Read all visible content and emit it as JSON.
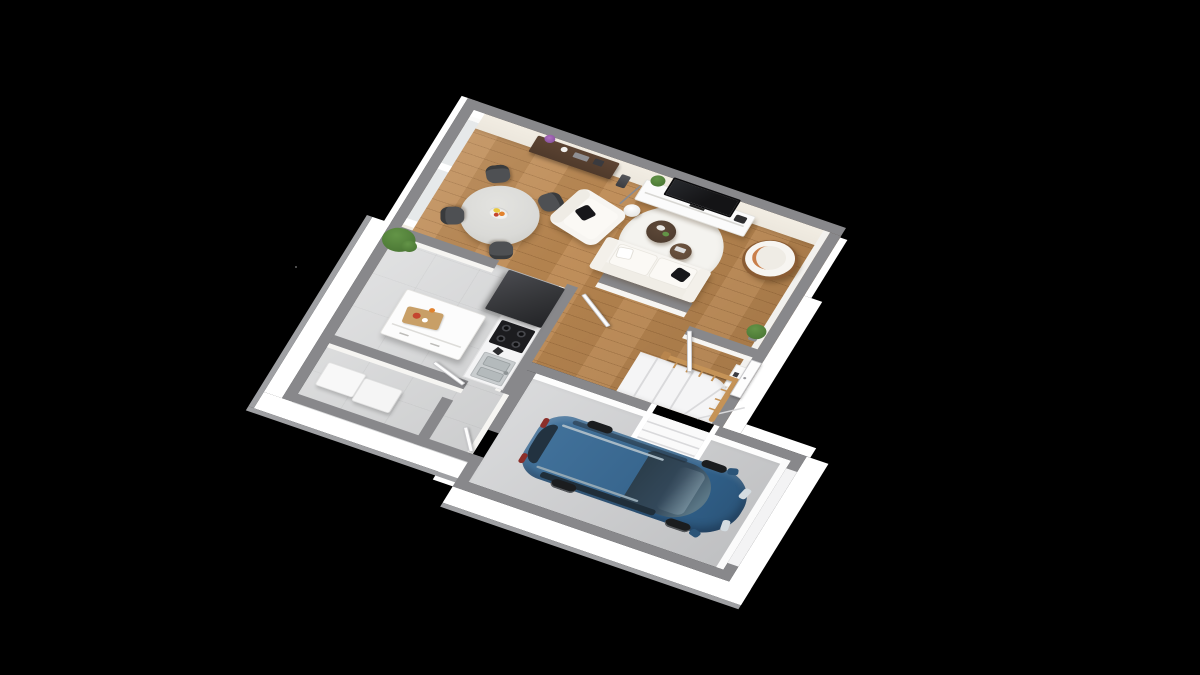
{
  "scene": {
    "label": "3D isometric floor plan rendering of a ground floor: open living-dining room with wood floor, kitchen with island, laundry room, hallway with winder staircase, and a garage with a parked blue minivan, on a black background",
    "background": "#000000"
  },
  "rooms": {
    "living_dining": {
      "label": "Living and dining room",
      "floor": "wood planks"
    },
    "kitchen": {
      "label": "Kitchen",
      "floor": "grey tile"
    },
    "laundry": {
      "label": "Laundry / storage room",
      "floor": "grey tile"
    },
    "hallway": {
      "label": "Hallway with staircase",
      "floor": "wood planks"
    },
    "garage": {
      "label": "Garage",
      "floor": "grey concrete"
    }
  },
  "furniture": {
    "dining": [
      "round pedestal dining table",
      "fruit bowl with bananas, oranges and apples",
      "four dark grey dining chairs",
      "large potted plant on half wall"
    ],
    "living": [
      "dark-wood console table with orchid and vases",
      "white TV sideboard",
      "black flat-screen TV",
      "small potted plant on sideboard",
      "arc floor lamp with round white base",
      "dark speaker column",
      "white armchair with black cushion",
      "white two-seat sofa with black cushion",
      "freestanding divider wall behind sofa",
      "round cream rug",
      "two round dark-wood coffee tables",
      "barrel armchair with wooden legs",
      "corner potted plant"
    ],
    "kitchen": [
      "white kitchen island with cutting board and tomatoes",
      "tall dark fridge/oven tower",
      "white counter with black cooktop",
      "stainless steel sink"
    ],
    "laundry": [
      "white two-module storage bench"
    ],
    "hallway": [
      "white winder staircase",
      "wooden balustrade",
      "small white entry cabinet"
    ],
    "garage": [
      "blue minivan"
    ]
  },
  "car": {
    "label": "blue minivan parked in garage",
    "color": "#3a6990"
  },
  "doors": [
    "open double doors between living room and hallway",
    "open kitchen door",
    "open garage access door",
    "entry door in east wall"
  ],
  "colors": {
    "bg": "#000000",
    "wall-cap": "#88888b",
    "wall-cream": "#ece7dd",
    "wall-white": "#f6f5f2",
    "wood": "#bc8952",
    "tile": "#d7d8d9",
    "garage-floor": "#cfd0d2",
    "glass": "#e6e9ea",
    "skirt": "#ffffff",
    "slab": "#9fa0a3",
    "sofa": "#f7f5f1",
    "pillow": "#17171a",
    "chair": "#4e5053",
    "table": "#dadad7",
    "console": "#4f3a2b",
    "coffee-1": "#4a392c",
    "coffee-2": "#5c4636",
    "tv": "#141416",
    "unit": "#fbfbfb",
    "armchair-wood": "#8a5c33",
    "stair-wood": "#c59357",
    "tread-line": "#d9d9db",
    "plant": "#4e7b37",
    "plant-light": "#639447",
    "car-body": "#3a6990",
    "car-dark": "#2b5478",
    "car-glass": "#2a3c49",
    "car-glass-light": "#5b7786",
    "fridge": "#343538",
    "cooktop": "#1c1c1f",
    "board": "#c89f67",
    "fruit-yellow": "#e9c83f",
    "fruit-orange": "#e2822d",
    "fruit-red": "#c4452f",
    "sink": "#c9cdcf"
  }
}
